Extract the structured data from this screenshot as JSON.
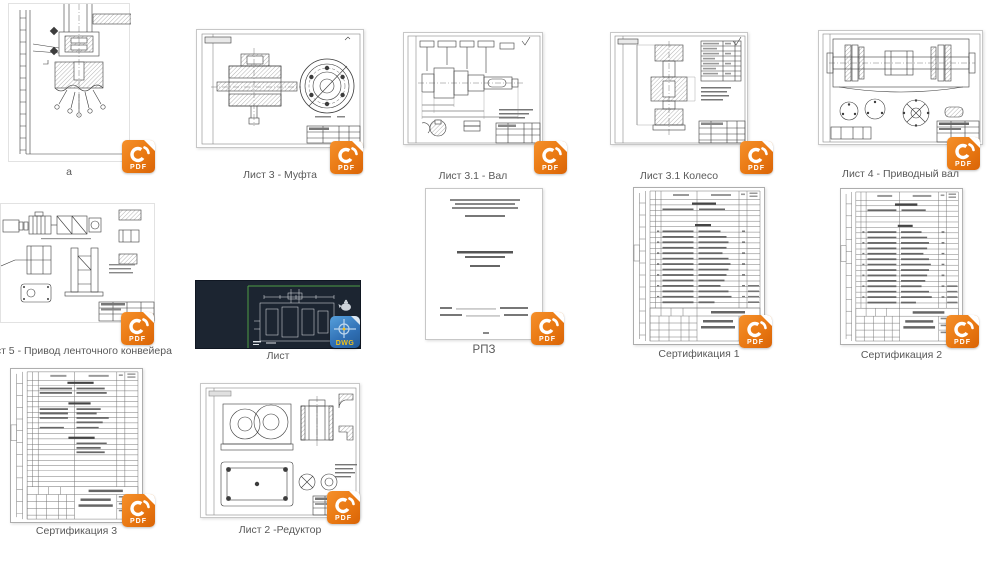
{
  "window": {
    "description": "Grid of exported drawing files with format badges",
    "background": "#ffffff"
  },
  "badge_labels": {
    "pdf": "PDF",
    "dwg": "DWG"
  },
  "colors": {
    "pdf_badge_orange": "#e97812",
    "dwg_badge_blue": "#2f6fb4",
    "dwg_badge_text_yellow": "#f2c21a",
    "cad_background": "#1c2531",
    "cad_guide_green": "#4e9d45",
    "caption_text": "#595959"
  },
  "items": [
    {
      "label": "а",
      "type": "pdf"
    },
    {
      "label": "Лист 3 - Муфта",
      "type": "pdf"
    },
    {
      "label": "Лист 3.1 - Вал",
      "type": "pdf"
    },
    {
      "label": "Лист 3.1 Колесо",
      "type": "pdf"
    },
    {
      "label": "Лист 4 - Приводный вал",
      "type": "pdf"
    },
    {
      "label": "Лист 5 - Привод ленточного конвейера",
      "type": "pdf"
    },
    {
      "label": "Лист",
      "type": "dwg"
    },
    {
      "label": "РПЗ",
      "type": "pdf"
    },
    {
      "label": "Сертификация 1",
      "type": "pdf"
    },
    {
      "label": "Сертификация 2",
      "type": "pdf"
    },
    {
      "label": "Сертификация 3",
      "type": "pdf"
    },
    {
      "label": "Лист 2 -Редуктор",
      "type": "pdf"
    }
  ]
}
